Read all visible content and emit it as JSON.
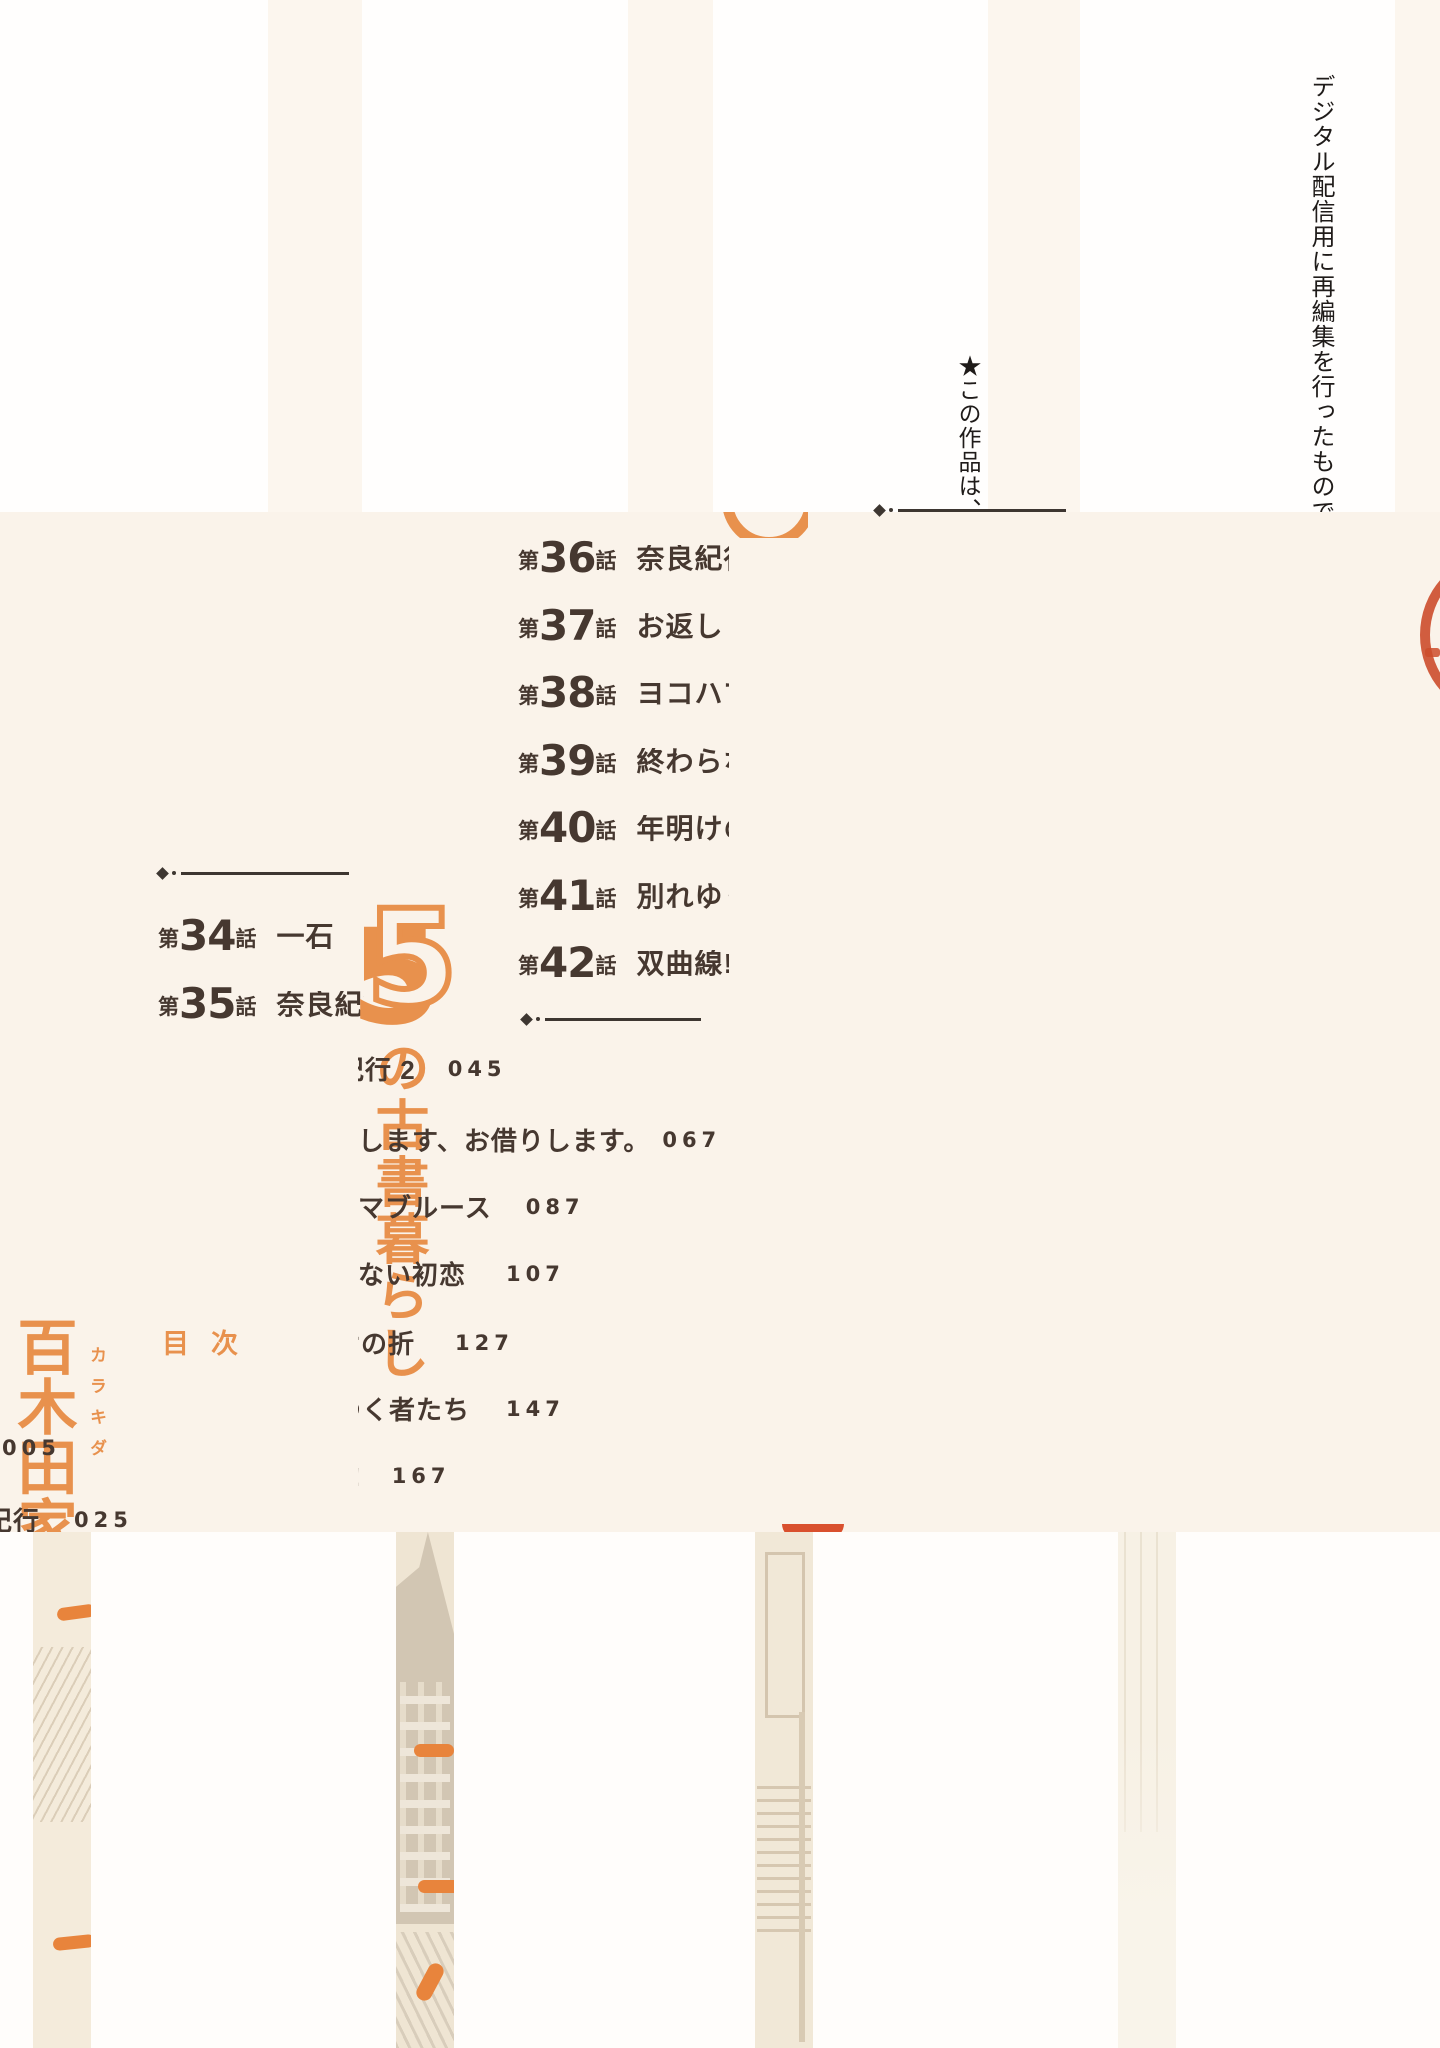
{
  "colors": {
    "cream": "#faf3ea",
    "white": "#fffefd",
    "orange": "#e8914d",
    "text_dark": "#463830",
    "divider": "#3d3631",
    "stamp_red": "#cc4c2c",
    "orange_dash": "#e8843c"
  },
  "copyright_notice": {
    "line1": "★この作品は、",
    "line2": "デジタル配信用に再編集を行ったものです。",
    "stray_comma": "、"
  },
  "book": {
    "family_title": "百木田家",
    "furigana": "カラキダ",
    "series_subtitle": "の古書暮らし",
    "volume_number": "5",
    "toc_label": "目次"
  },
  "toc": {
    "chapter_prefix": "第",
    "chapter_suffix": "話",
    "left": [
      {
        "num": "34",
        "title": "一石"
      },
      {
        "num": "35",
        "title": "奈良紀行"
      }
    ],
    "right": [
      {
        "num": "36",
        "title": "奈良紀行"
      },
      {
        "num": "37",
        "title": "お返しし"
      },
      {
        "num": "38",
        "title": "ヨコハマ"
      },
      {
        "num": "39",
        "title": "終わらな"
      },
      {
        "num": "40",
        "title": "年明けの"
      },
      {
        "num": "41",
        "title": "別れゆく"
      },
      {
        "num": "42",
        "title": "双曲線!"
      }
    ],
    "continuation": [
      {
        "prefix": "紀",
        "text": "行 2",
        "page": "045"
      },
      {
        "prefix": "",
        "text": "します、お借りします。",
        "page": "067"
      },
      {
        "prefix": "",
        "text": "マブルース",
        "page": "087"
      },
      {
        "prefix": "",
        "text": "ない初恋",
        "page": "107"
      },
      {
        "prefix": "け",
        "text": "の折",
        "page": "127"
      },
      {
        "prefix": "ゆ",
        "text": "く者たち",
        "page": "147"
      },
      {
        "prefix": "線",
        "text": "!",
        "page": "167"
      }
    ],
    "fragment_page_005": "005",
    "fragment_row_025": {
      "prefix_text": "紀行",
      "page": "025"
    }
  },
  "stamp": {
    "right_text": "梓澤",
    "left_text": "蔵書",
    "bottle_label": "AZUS"
  }
}
